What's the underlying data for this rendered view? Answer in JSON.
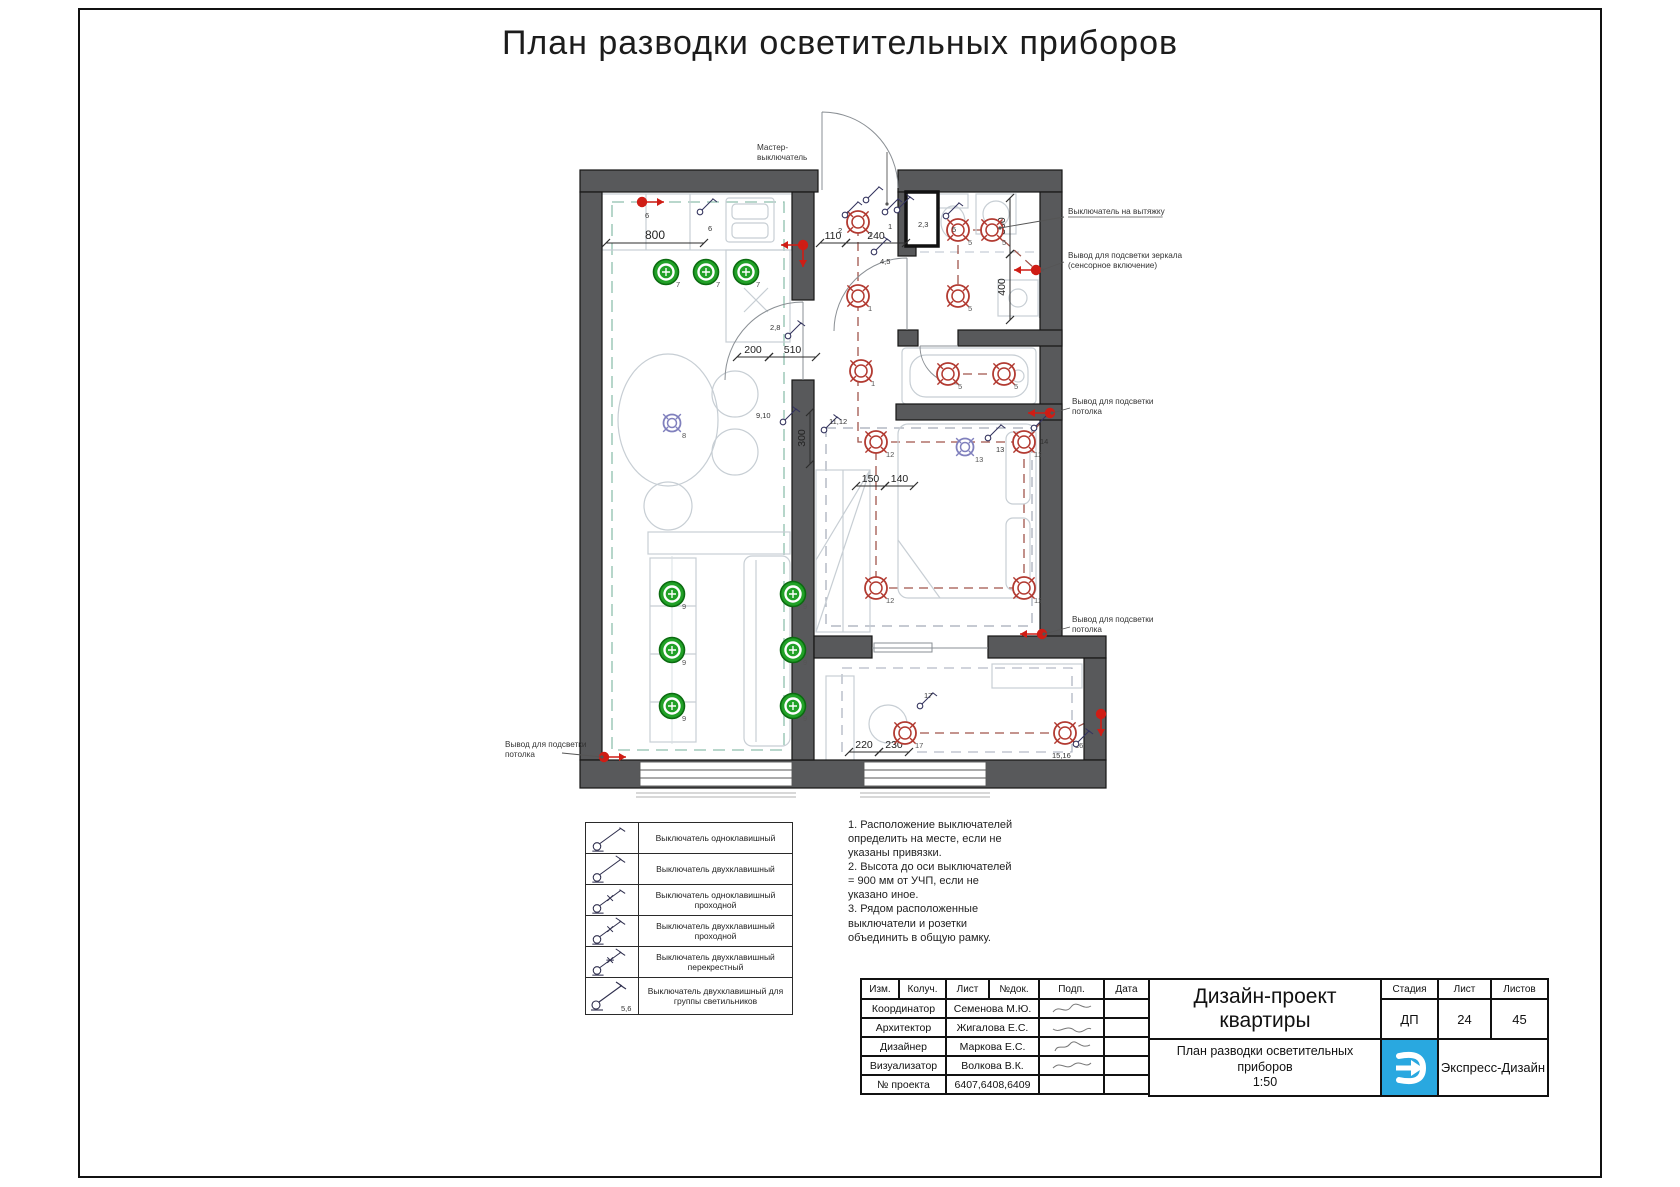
{
  "page": {
    "title": "План разводки осветительных приборов"
  },
  "colors": {
    "green": "#21a127",
    "green_dark": "#0b6b10",
    "red": "#b23a31",
    "blue": "#8080bd",
    "dot_red": "#cf1d15",
    "wall": "#58595b",
    "dash_teal": "#8fbfae",
    "dash_warm": "#a0554b",
    "dash_gray": "#a3aab8",
    "logo_blue": "#29a8e0"
  },
  "plan": {
    "lights": [
      {
        "type": "g",
        "x": 666,
        "y": 272,
        "label": "7"
      },
      {
        "type": "g",
        "x": 706,
        "y": 272,
        "label": "7"
      },
      {
        "type": "g",
        "x": 746,
        "y": 272,
        "label": "7"
      },
      {
        "type": "g",
        "x": 672,
        "y": 594,
        "label": "9"
      },
      {
        "type": "g",
        "x": 672,
        "y": 650,
        "label": "9"
      },
      {
        "type": "g",
        "x": 672,
        "y": 706,
        "label": "9"
      },
      {
        "type": "g",
        "x": 793,
        "y": 594,
        "label": "9"
      },
      {
        "type": "g",
        "x": 793,
        "y": 650,
        "label": "9"
      },
      {
        "type": "g",
        "x": 793,
        "y": 706,
        "label": "9"
      },
      {
        "type": "b",
        "x": 672,
        "y": 423,
        "label": "8"
      },
      {
        "type": "b",
        "x": 965,
        "y": 447,
        "label": "13"
      },
      {
        "type": "r",
        "x": 858,
        "y": 222,
        "label": "1"
      },
      {
        "type": "r",
        "x": 858,
        "y": 296,
        "label": "1"
      },
      {
        "type": "r",
        "x": 861,
        "y": 371,
        "label": "1"
      },
      {
        "type": "r",
        "x": 958,
        "y": 230,
        "label": "5"
      },
      {
        "type": "r",
        "x": 992,
        "y": 230,
        "label": "5"
      },
      {
        "type": "r",
        "x": 958,
        "y": 296,
        "label": "5"
      },
      {
        "type": "r",
        "x": 948,
        "y": 374,
        "label": "5"
      },
      {
        "type": "r",
        "x": 1004,
        "y": 374,
        "label": "5"
      },
      {
        "type": "r",
        "x": 876,
        "y": 442,
        "label": "12"
      },
      {
        "type": "r",
        "x": 1024,
        "y": 442,
        "label": "12"
      },
      {
        "type": "r",
        "x": 876,
        "y": 588,
        "label": "12"
      },
      {
        "type": "r",
        "x": 1024,
        "y": 588,
        "label": "12"
      },
      {
        "type": "r",
        "x": 905,
        "y": 733,
        "label": "17"
      },
      {
        "type": "r",
        "x": 1065,
        "y": 733,
        "label": "16"
      }
    ],
    "switches": [
      {
        "x": 700,
        "y": 212,
        "label": "6",
        "lx": 708,
        "ly": 231
      },
      {
        "x": 866,
        "y": 200,
        "label": "",
        "lx": 0,
        "ly": 0
      },
      {
        "x": 845,
        "y": 215,
        "label": "2",
        "lx": 838,
        "ly": 233
      },
      {
        "x": 885,
        "y": 212,
        "label": "1",
        "lx": 888,
        "ly": 229
      },
      {
        "x": 897,
        "y": 210,
        "label": "2,3",
        "lx": 918,
        "ly": 227
      },
      {
        "x": 946,
        "y": 216,
        "label": "5",
        "lx": 952,
        "ly": 232
      },
      {
        "x": 874,
        "y": 252,
        "label": "4,5",
        "lx": 880,
        "ly": 264
      },
      {
        "x": 788,
        "y": 336,
        "label": "2,8",
        "lx": 770,
        "ly": 330
      },
      {
        "x": 783,
        "y": 422,
        "label": "9,10",
        "lx": 756,
        "ly": 418
      },
      {
        "x": 824,
        "y": 430,
        "label": "11,12",
        "lx": 829,
        "ly": 424
      },
      {
        "x": 988,
        "y": 438,
        "label": "13",
        "lx": 996,
        "ly": 452
      },
      {
        "x": 1034,
        "y": 428,
        "label": "14",
        "lx": 1040,
        "ly": 444
      },
      {
        "x": 920,
        "y": 706,
        "label": "17",
        "lx": 924,
        "ly": 698
      },
      {
        "x": 1076,
        "y": 744,
        "label": "15,16",
        "lx": 1052,
        "ly": 758
      }
    ],
    "outputs": [
      {
        "x": 642,
        "y": 202,
        "dirs": [
          "right"
        ],
        "label": "6"
      },
      {
        "x": 803,
        "y": 245,
        "dirs": [
          "left",
          "down"
        ],
        "label": ""
      },
      {
        "x": 1036,
        "y": 270,
        "dirs": [
          "left"
        ],
        "label": ""
      },
      {
        "x": 1050,
        "y": 413,
        "dirs": [
          "left"
        ],
        "label": ""
      },
      {
        "x": 1042,
        "y": 634,
        "dirs": [
          "left"
        ],
        "label": ""
      },
      {
        "x": 604,
        "y": 757,
        "dirs": [
          "right"
        ],
        "label": ""
      },
      {
        "x": 1101,
        "y": 714,
        "dirs": [
          "down"
        ],
        "label": ""
      }
    ],
    "dimensions": [
      {
        "x1": 606,
        "y1": 243,
        "x2": 704,
        "y2": 243,
        "label": "800",
        "vertical": false,
        "big": true
      },
      {
        "x1": 820,
        "y1": 243,
        "x2": 846,
        "y2": 243,
        "label": "110",
        "vertical": false
      },
      {
        "x1": 846,
        "y1": 243,
        "x2": 906,
        "y2": 243,
        "label": "240",
        "vertical": false
      },
      {
        "x1": 737,
        "y1": 357,
        "x2": 769,
        "y2": 357,
        "label": "200",
        "vertical": false
      },
      {
        "x1": 769,
        "y1": 357,
        "x2": 816,
        "y2": 357,
        "label": "510",
        "vertical": false
      },
      {
        "x1": 1010,
        "y1": 198,
        "x2": 1010,
        "y2": 254,
        "label": "300",
        "vertical": true
      },
      {
        "x1": 1010,
        "y1": 254,
        "x2": 1010,
        "y2": 320,
        "label": "400",
        "vertical": true
      },
      {
        "x1": 810,
        "y1": 412,
        "x2": 810,
        "y2": 464,
        "label": "300",
        "vertical": true
      },
      {
        "x1": 856,
        "y1": 486,
        "x2": 885,
        "y2": 486,
        "label": "150",
        "vertical": false
      },
      {
        "x1": 885,
        "y1": 486,
        "x2": 914,
        "y2": 486,
        "label": "140",
        "vertical": false
      },
      {
        "x1": 849,
        "y1": 752,
        "x2": 879,
        "y2": 752,
        "label": "220",
        "vertical": false
      },
      {
        "x1": 879,
        "y1": 752,
        "x2": 909,
        "y2": 752,
        "label": "230",
        "vertical": false
      }
    ],
    "annotations": [
      {
        "x": 757,
        "y": 150,
        "lines": [
          "Мастер-",
          "выключатель"
        ],
        "underline": false,
        "leader": [
          [
            887,
            152
          ],
          [
            887,
            204
          ]
        ]
      },
      {
        "x": 1068,
        "y": 214,
        "lines": [
          "Выключатель на вытяжку"
        ],
        "underline": true,
        "leader": [
          [
            1064,
            217
          ],
          [
            1000,
            228
          ]
        ]
      },
      {
        "x": 1068,
        "y": 258,
        "lines": [
          "Вывод для подсветки зеркала",
          "(сенсорное включение)"
        ],
        "underline": false,
        "leader": [
          [
            1064,
            262
          ],
          [
            1042,
            270
          ]
        ]
      },
      {
        "x": 1072,
        "y": 404,
        "lines": [
          "Вывод для подсветки",
          "потолка"
        ],
        "underline": false,
        "leader": [
          [
            1070,
            408
          ],
          [
            1052,
            413
          ]
        ]
      },
      {
        "x": 1072,
        "y": 622,
        "lines": [
          "Вывод для подсветки",
          "потолка"
        ],
        "underline": false,
        "leader": [
          [
            1070,
            627
          ],
          [
            1044,
            634
          ]
        ]
      },
      {
        "x": 505,
        "y": 747,
        "lines": [
          "Вывод для подсветки",
          "потолка"
        ],
        "underline": false,
        "leader": [
          [
            562,
            753
          ],
          [
            602,
            757
          ]
        ]
      }
    ]
  },
  "legend": {
    "rows": [
      {
        "label": "Выключатель одноклавишный",
        "keys": 1,
        "cross": false,
        "star": false,
        "tag": ""
      },
      {
        "label": "Выключатель двухклавишный",
        "keys": 2,
        "cross": false,
        "star": false,
        "tag": ""
      },
      {
        "label": "Выключатель одноклавишный проходной",
        "keys": 1,
        "cross": true,
        "star": false,
        "tag": ""
      },
      {
        "label": "Выключатель двухклавишный проходной",
        "keys": 2,
        "cross": true,
        "star": false,
        "tag": ""
      },
      {
        "label": "Выключатель двухклавишный перекрестный",
        "keys": 2,
        "cross": false,
        "star": true,
        "tag": ""
      },
      {
        "label": "Выключатель двухклавишный для группы светильников",
        "keys": 2,
        "cross": false,
        "star": false,
        "tag": "5,6"
      }
    ]
  },
  "notes": [
    "1. Расположение выключателей определить на месте, если не указаны привязки.",
    "2. Высота до оси выключателей = 900 мм от УЧП, если не указано иное.",
    "3. Рядом расположенные выключатели и розетки объединить в общую рамку."
  ],
  "titleblock": {
    "headers": [
      "Изм.",
      "Колуч.",
      "Лист",
      "№док.",
      "Подп.",
      "Дата"
    ],
    "rows": [
      {
        "role": "Координатор",
        "name": "Семенова М.Ю."
      },
      {
        "role": "Архитектор",
        "name": "Жигалова Е.С."
      },
      {
        "role": "Дизайнер",
        "name": "Маркова Е.С."
      },
      {
        "role": "Визуализатор",
        "name": "Волкова В.К."
      },
      {
        "role": "№ проекта",
        "name": "6407,6408,6409"
      }
    ],
    "project_title": "Дизайн-проект квартиры",
    "stage_header": "Стадия",
    "sheet_header": "Лист",
    "sheets_header": "Листов",
    "stage": "ДП",
    "sheet": "24",
    "sheets": "45",
    "sheet_title": "План разводки осветительных приборов",
    "scale": "1:50",
    "company": "Экспресс-Дизайн"
  }
}
